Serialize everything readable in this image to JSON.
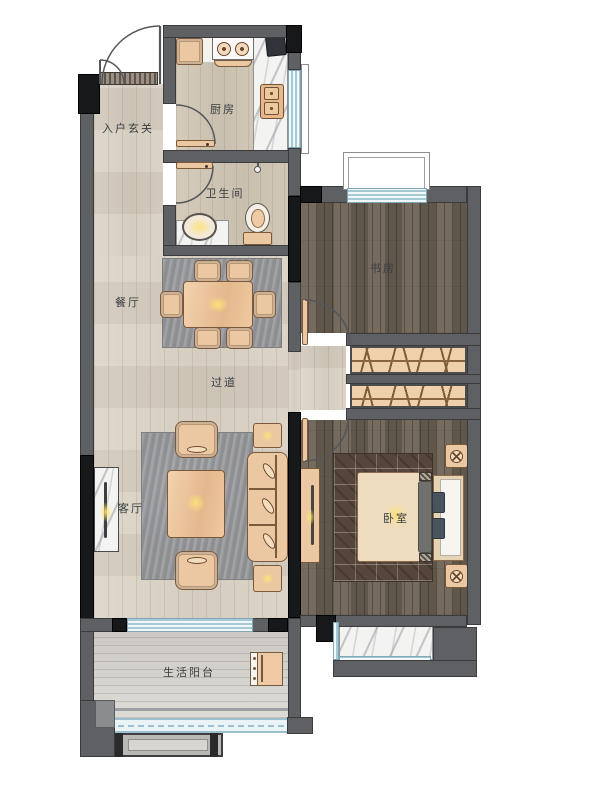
{
  "plan": {
    "type": "apartment-floor-plan",
    "rooms": [
      {
        "id": "entry",
        "label": "入户玄关"
      },
      {
        "id": "kitchen",
        "label": "厨房"
      },
      {
        "id": "bathroom",
        "label": "卫生间"
      },
      {
        "id": "dining",
        "label": "餐厅"
      },
      {
        "id": "hallway",
        "label": "过道"
      },
      {
        "id": "living",
        "label": "客厅"
      },
      {
        "id": "study",
        "label": "书房"
      },
      {
        "id": "bedroom",
        "label": "卧室"
      },
      {
        "id": "balcony",
        "label": "生活阳台"
      }
    ],
    "colors": {
      "wall": "#5e6063",
      "wall_accent": "#16181a",
      "floor_light": "#d8d1c4",
      "floor_dark": "#6b6154",
      "window_blue": "#a6c9d6",
      "furniture": "#ecc8a2",
      "rug_gray": "#96979a",
      "rug_dark": "#55453a",
      "marble": "#f3f3f1"
    }
  }
}
